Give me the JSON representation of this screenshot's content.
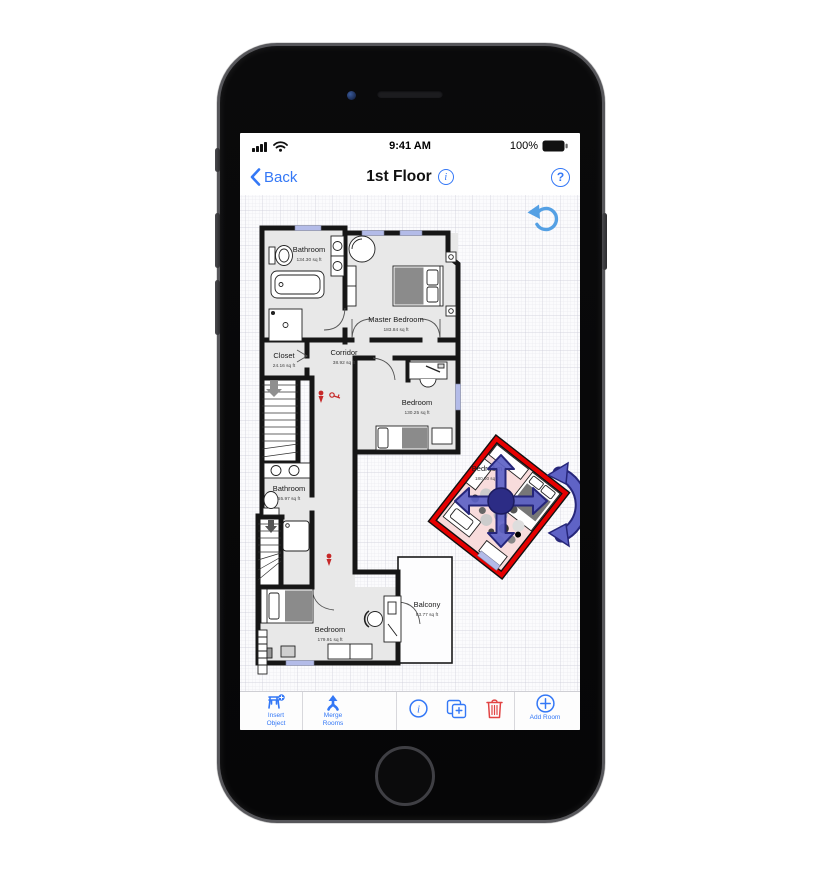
{
  "status": {
    "time": "9:41 AM",
    "battery": "100%"
  },
  "nav": {
    "back": "Back",
    "title": "1st Floor",
    "info_glyph": "i",
    "help_glyph": "?"
  },
  "canvas": {
    "rooms": [
      {
        "name": "Bathroom",
        "area": "134.30 sq ft"
      },
      {
        "name": "Master Bedroom",
        "area": "183.84 sq ft"
      },
      {
        "name": "Closet",
        "area": "24.16 sq ft"
      },
      {
        "name": "Corridor",
        "area": "38.92 sq ft"
      },
      {
        "name": "Bedroom",
        "area": "130.25 sq ft"
      },
      {
        "name": "Bathroom",
        "area": "55.97 sq ft"
      },
      {
        "name": "Bedroom",
        "area": "179.91 sq ft"
      },
      {
        "name": "Balcony",
        "area": "83.77 sq ft"
      },
      {
        "name": "Bedroom",
        "area": "180.00 sq ft",
        "selected": "true"
      }
    ]
  },
  "toolbar": {
    "insert_line1": "Insert",
    "insert_line2": "Object",
    "merge_line1": "Merge",
    "merge_line2": "Rooms",
    "info_glyph": "i",
    "add_room": "Add Room"
  },
  "colors": {
    "accent_blue": "#3478F6",
    "selection_red": "#e60000",
    "selection_fill": "#f8dcdc",
    "arrow_blue": "#5f63c6",
    "trash_red": "#e24444",
    "undo_blue": "#54a0e4",
    "wall_black": "#161616",
    "room_gray": "#e8e8e8",
    "window_lavender": "#b3bbe8"
  }
}
